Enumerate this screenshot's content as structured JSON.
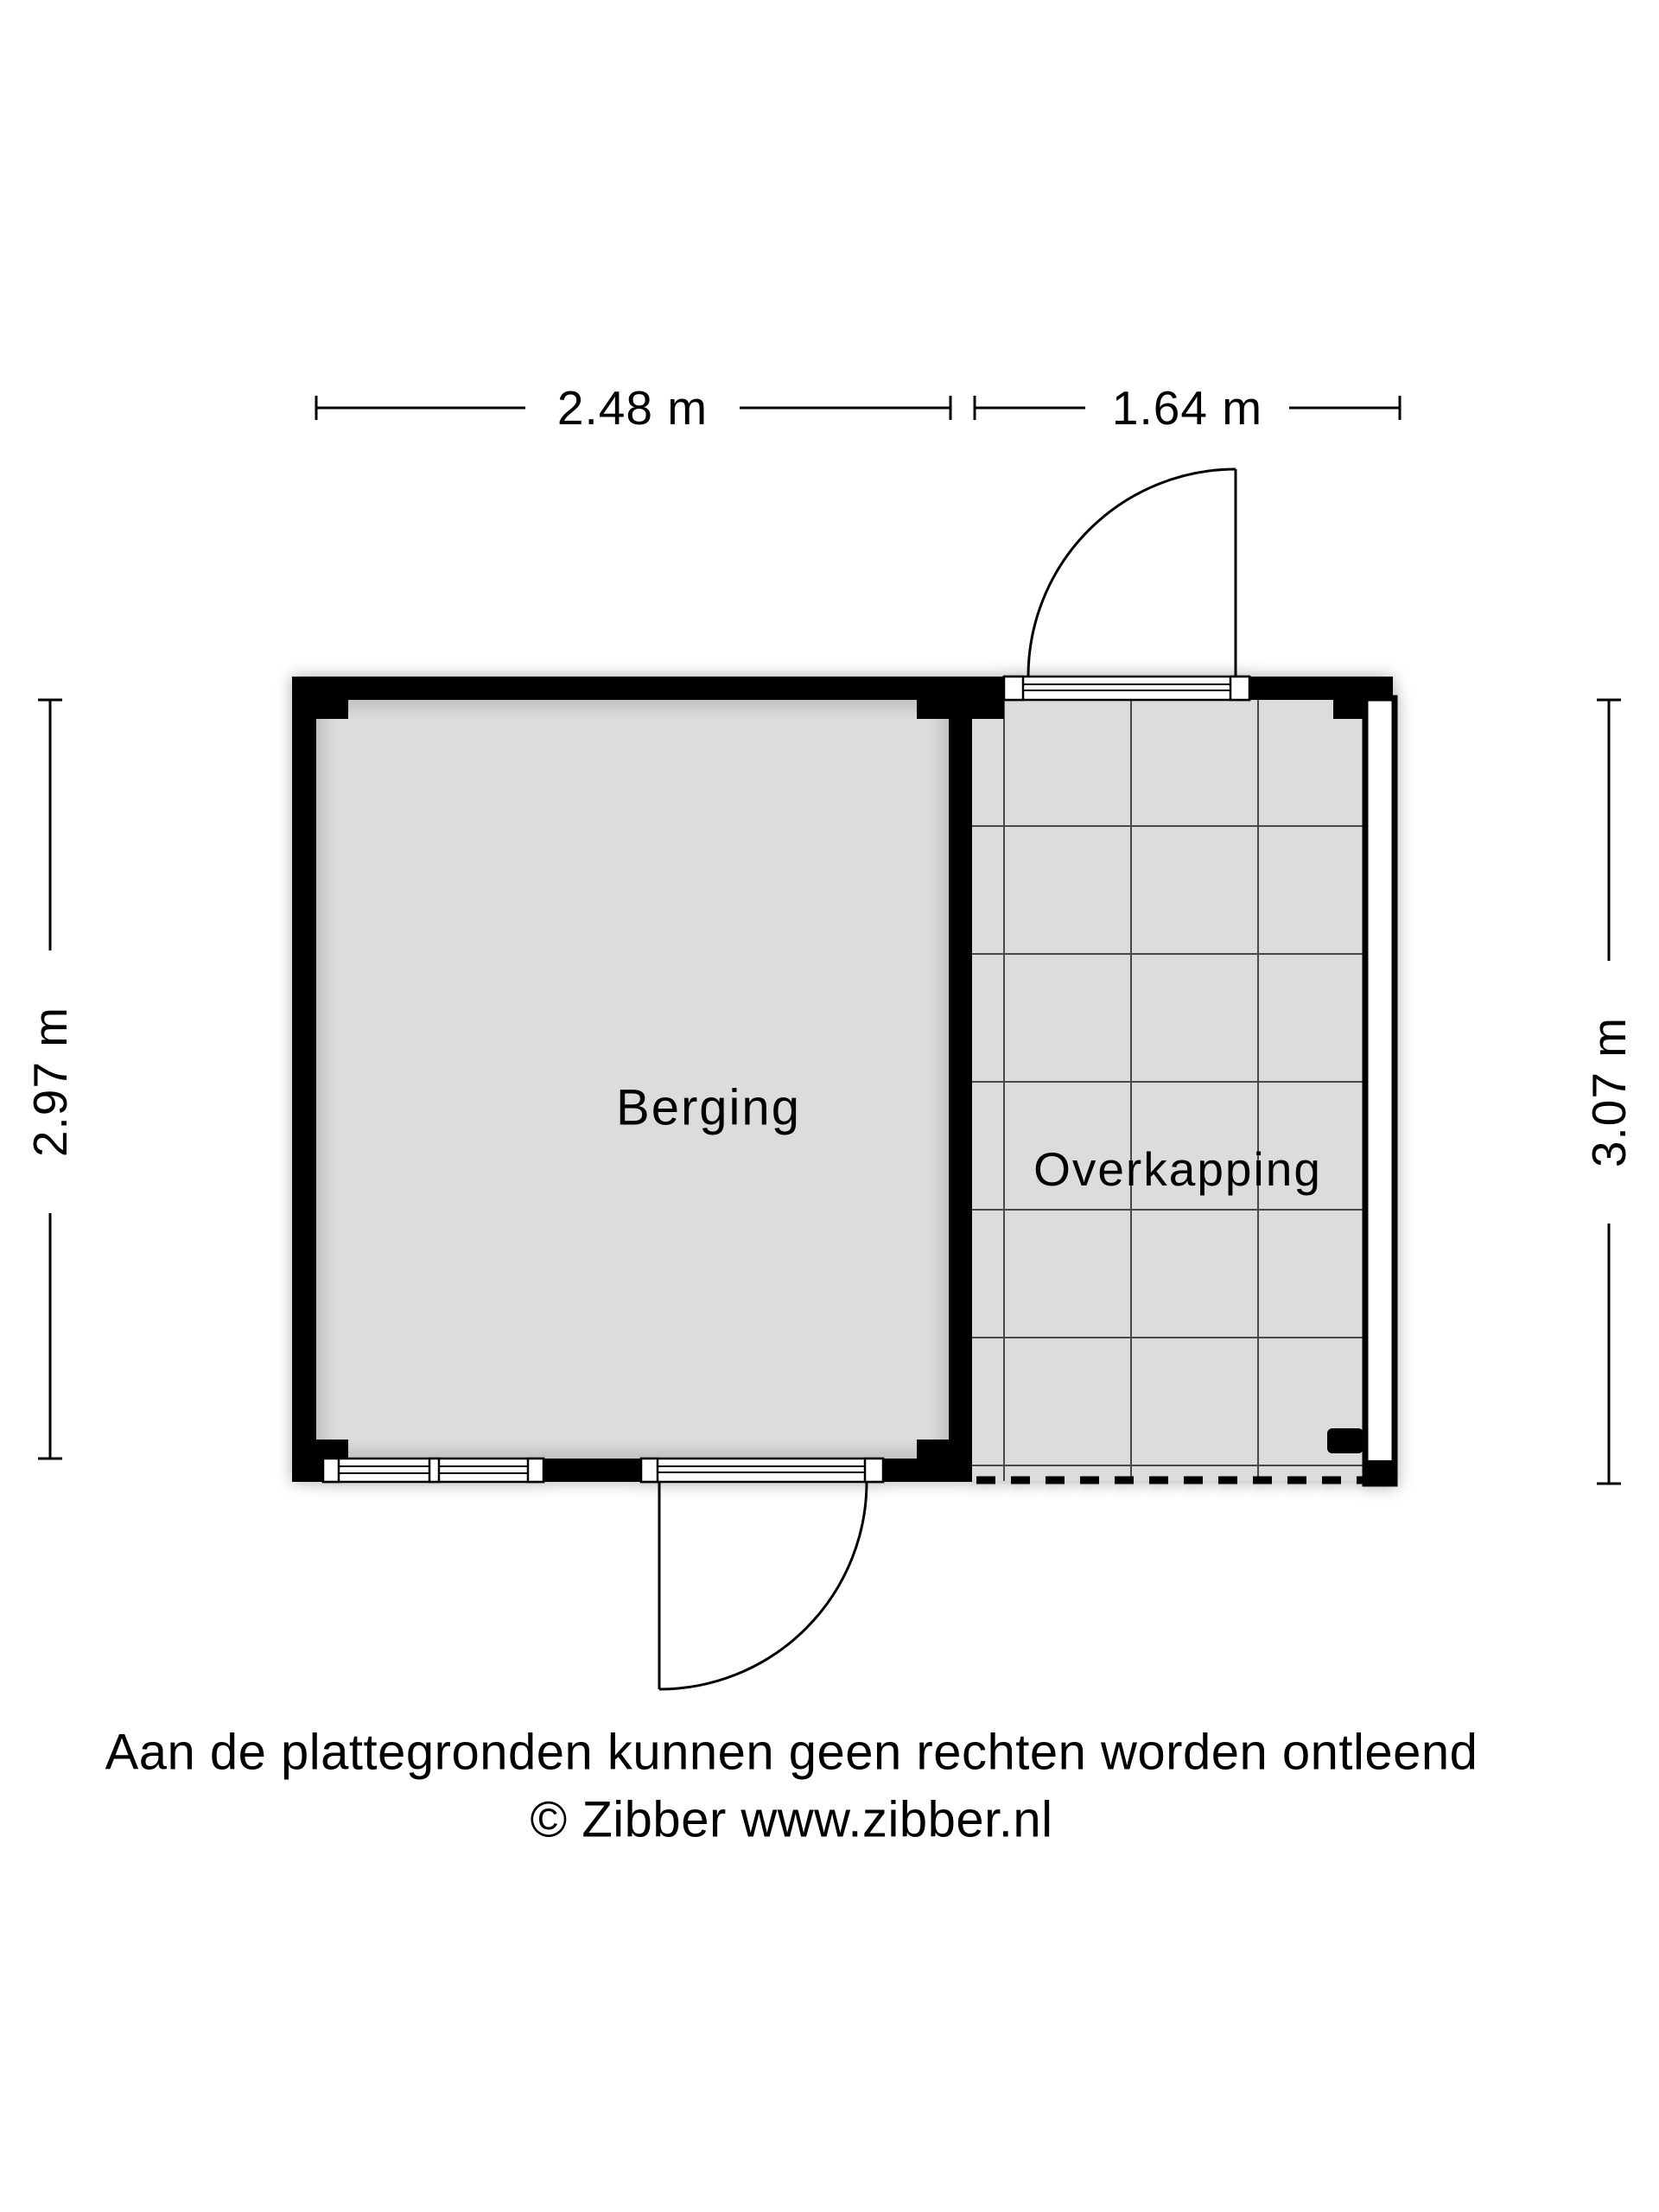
{
  "plan": {
    "title": "Berging / Overkapping floorplan",
    "rooms": [
      {
        "name": "Berging"
      },
      {
        "name": "Overkapping"
      }
    ],
    "dimensions": {
      "top_left": "2.48 m",
      "top_right": "1.64 m",
      "left": "2.97 m",
      "right": "3.07 m"
    },
    "footer": {
      "line1": "Aan de plattegronden kunnen geen rechten worden ontleend",
      "line2": "© Zibber www.zibber.nl"
    },
    "colors": {
      "wall": "#000000",
      "floor": "#dcdcdc",
      "grid_line": "#4a4a4a",
      "glass": "#ffffff",
      "background": "#ffffff"
    }
  }
}
